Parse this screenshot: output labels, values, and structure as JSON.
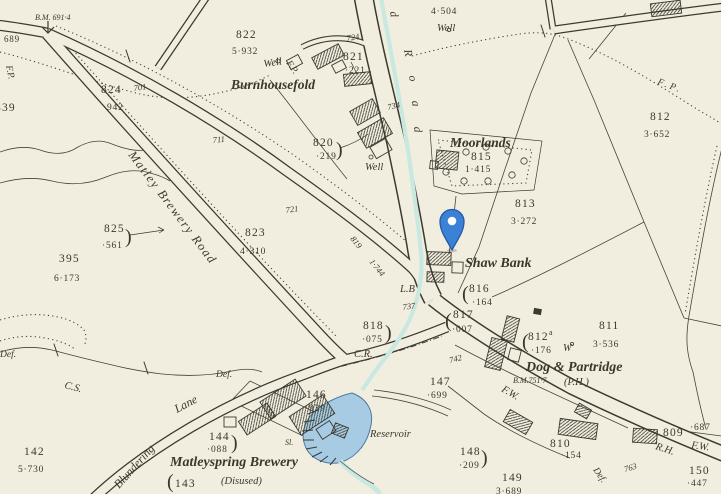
{
  "map": {
    "labels": {
      "bm_top": "B.M. 691·4",
      "spot_689": "689",
      "fp": "F.P.",
      "plot_839": "839",
      "plot_824": "824",
      "area_824": "·942",
      "spot_701": "701",
      "spot_711": "711",
      "spot_721": "721",
      "spot_724": "724",
      "spot_734": "734",
      "spot_737": "737",
      "spot_742": "742",
      "spot_763": "763",
      "plot_822": "822",
      "area_822": "5·932",
      "well": "Well",
      "burnhousefold": "Burnhousefold",
      "plot_821": "821",
      "area_821": "·221",
      "plot_820": "820",
      "area_820": "·219",
      "area_4504": "4·504",
      "plot_812": "812",
      "area_812": "3·652",
      "moorlands": "Moorlands",
      "plot_815": "815",
      "area_815": "1·415",
      "plot_813": "813",
      "area_813": "3·272",
      "shaw_bank": "Shaw Bank",
      "lb": "L.B",
      "plot_816": "816",
      "area_816": "·164",
      "plot_817": "817",
      "area_817": "·007",
      "plot_818": "818",
      "area_818": "·075",
      "cr": "C.R.",
      "road_819": "819",
      "road_819_dist": "1·744",
      "matley_brewery_road": "Matley Brewery Road",
      "plot_825": "825",
      "area_825": "·561",
      "plot_395": "395",
      "area_395": "6·173",
      "plot_823": "823",
      "area_823": "4·310",
      "def": "Def.",
      "cs": "C.S.",
      "plot_142": "142",
      "area_142": "5·730",
      "blundering": "Blundering",
      "lane": "Lane",
      "plot_144": "144",
      "area_144": "·088",
      "matleyspring_brewery": "Matleyspring Brewery",
      "disused": "(Disused)",
      "plot_143": "143",
      "plot_146": "146",
      "area_146": "·939",
      "sl": "Sl.",
      "reservoir": "Reservoir",
      "plot_147": "147",
      "area_147": "·699",
      "plot_148": "148",
      "area_148": "·209",
      "plot_149": "149",
      "area_149": "3·689",
      "fw": "F.W.",
      "plot_812a": "812",
      "plot_812a_sup": "a",
      "area_812a": "·176",
      "w_well": "W",
      "plot_811": "811",
      "area_811": "3·536",
      "dog_partridge": "Dog & Partridge",
      "bm_dog": "B.M.751·7",
      "ph": "(P.H.)",
      "plot_810": "810",
      "area_810": "·154",
      "plot_809": "809",
      "area_809": "·687",
      "rh": "R.H.",
      "plot_150": "150",
      "area_150": "·447"
    },
    "road_name_partial": "d",
    "road_name_letters": [
      "R",
      "o",
      "a",
      "d"
    ],
    "punct": {
      "open": "(",
      "close": ")"
    },
    "marker": {
      "kind": "location-pin"
    },
    "colors": {
      "background": "#f2eedf",
      "linework": "#3b3930",
      "water_fill": "#a6cbe2",
      "water_edge": "#4b7ba3",
      "stream": "#c9e8e2",
      "pin_fill": "#3b82d6",
      "pin_edge": "#2758a8",
      "pin_dot": "#ffffff"
    }
  }
}
